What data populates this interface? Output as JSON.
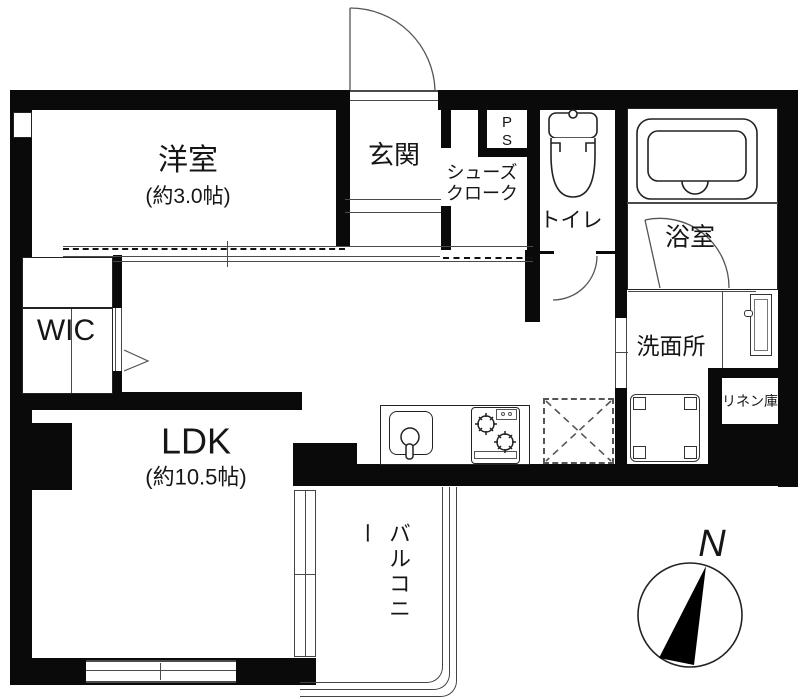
{
  "floorplan": {
    "rooms": {
      "western_room": {
        "name": "洋室",
        "size": "(約3.0帖)"
      },
      "entrance": {
        "name": "玄関"
      },
      "shoe_closet": {
        "line1": "シューズ",
        "line2": "クローク"
      },
      "pipe_space": {
        "line1": "P",
        "line2": "S"
      },
      "toilet": {
        "name": "トイレ"
      },
      "bathroom": {
        "name": "浴室"
      },
      "wic": {
        "name": "WIC"
      },
      "washroom": {
        "name": "洗面所"
      },
      "linen_closet": {
        "name": "リネン庫"
      },
      "ldk": {
        "name": "LDK",
        "size": "(約10.5帖)"
      },
      "balcony": {
        "name": "バルコニー"
      }
    },
    "compass": {
      "north_label": "N"
    },
    "colors": {
      "wall": "#0a0a0a",
      "line": "#4a4a4a",
      "background": "#ffffff"
    }
  }
}
